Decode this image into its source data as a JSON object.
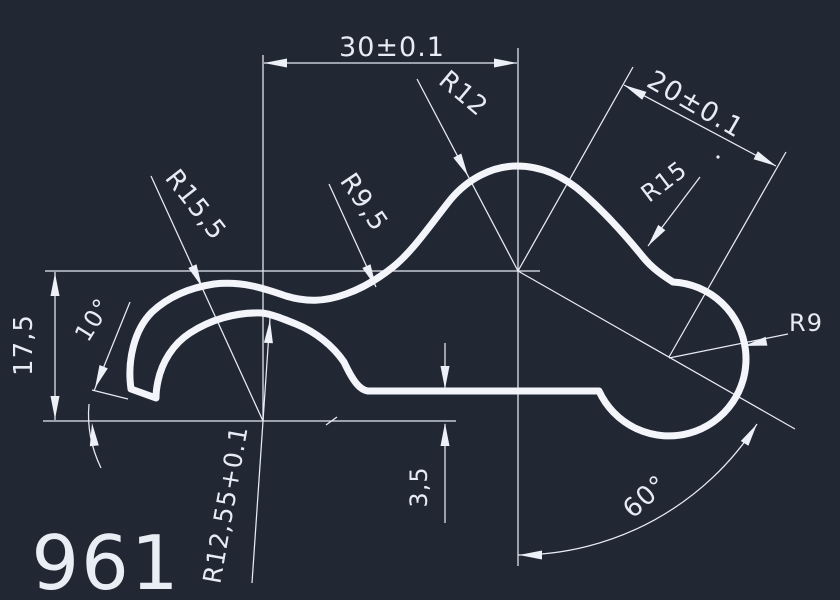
{
  "part_number": "961",
  "colors": {
    "background": "#212733",
    "line": "#edf1f7",
    "text": "#e7ebf3"
  },
  "labels": {
    "dim_width_top": "30±0.1",
    "dim_width_diagonal": "20±0.1",
    "dim_height_left": "17,5",
    "dim_flat_offset": "3,5",
    "angle_left": "10°",
    "angle_right": "60°",
    "radius_bump": "R12",
    "radius_lobe_outer": "R15",
    "radius_lobe": "R9",
    "radius_curl_outer": "R15,5",
    "radius_valley": "R9,5",
    "radius_curl_inner": "R12,55+0.1"
  }
}
